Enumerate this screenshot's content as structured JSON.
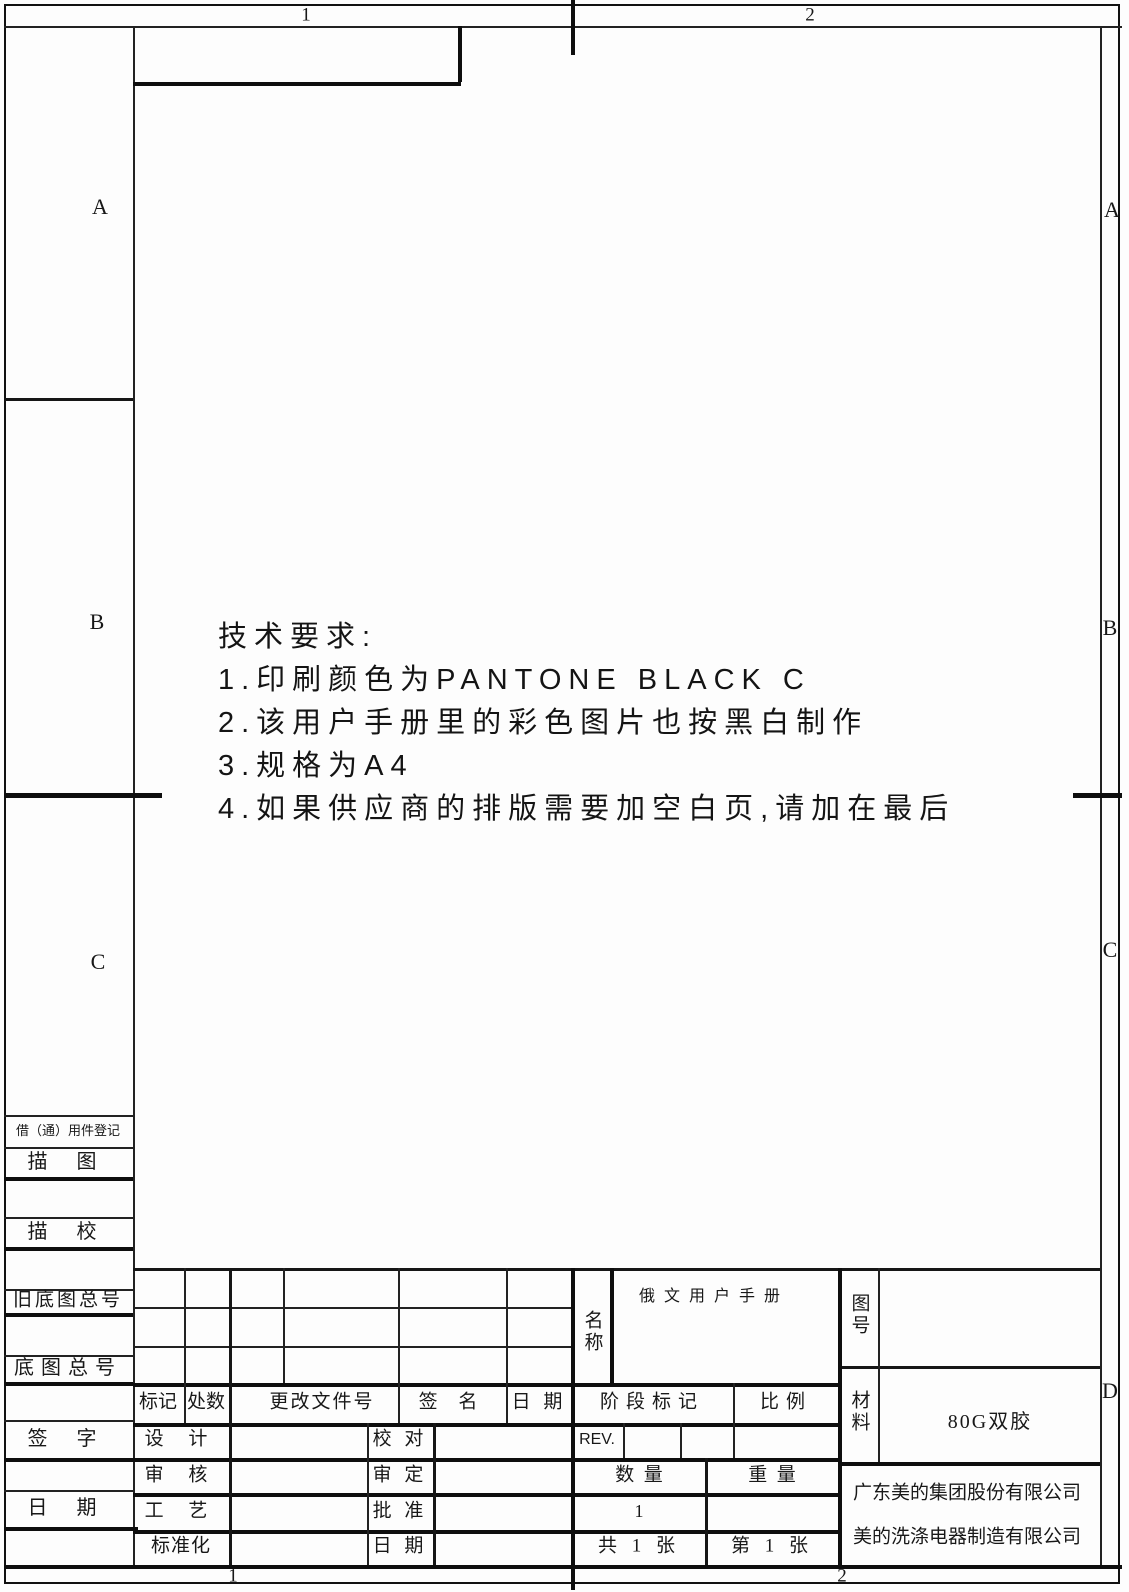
{
  "zones": {
    "top": [
      "1",
      "2"
    ],
    "bottom": [
      "1",
      "2"
    ],
    "left": [
      "A",
      "B",
      "C"
    ],
    "right": [
      "A",
      "B",
      "C",
      "D"
    ]
  },
  "technical_requirements": {
    "title": "技术要求:",
    "items": [
      "1.印刷颜色为PANTONE BLACK C",
      "2.该用户手册里的彩色图片也按黑白制作",
      "3.规格为A4",
      "4.如果供应商的排版需要加空白页,请加在最后"
    ]
  },
  "margin_column": {
    "borrow_common_parts_register": "借（通）用件登记",
    "tracing": "描 图",
    "tracing_check": "描 校",
    "old_master_drawing_no": "旧底图总号",
    "master_drawing_no": "底图总号",
    "signature": "签 字",
    "date": "日 期"
  },
  "title_block": {
    "revision_header": {
      "mark": "标记",
      "count": "处数",
      "change_doc_no": "更改文件号",
      "signature": "签 名",
      "date": "日 期"
    },
    "approval": {
      "design": "设 计",
      "proofread": "校 对",
      "review": "审 核",
      "examine": "审 定",
      "process": "工 艺",
      "approve": "批 准",
      "standardization": "标准化",
      "date": "日 期"
    },
    "stage_mark": "阶段标记",
    "scale": "比例",
    "rev": "REV.",
    "quantity_label": "数  量",
    "weight_label": "重  量",
    "quantity_value": "1",
    "sheet_total": "共 1 张",
    "sheet_number": "第 1 张",
    "name_label": "名称",
    "name_value": "俄文用户手册",
    "drawing_no_label": "图号",
    "material_label": "材料",
    "material_value": "80G双胶",
    "company_line1": "广东美的集团股份有限公司",
    "company_line2": "美的洗涤电器制造有限公司"
  }
}
